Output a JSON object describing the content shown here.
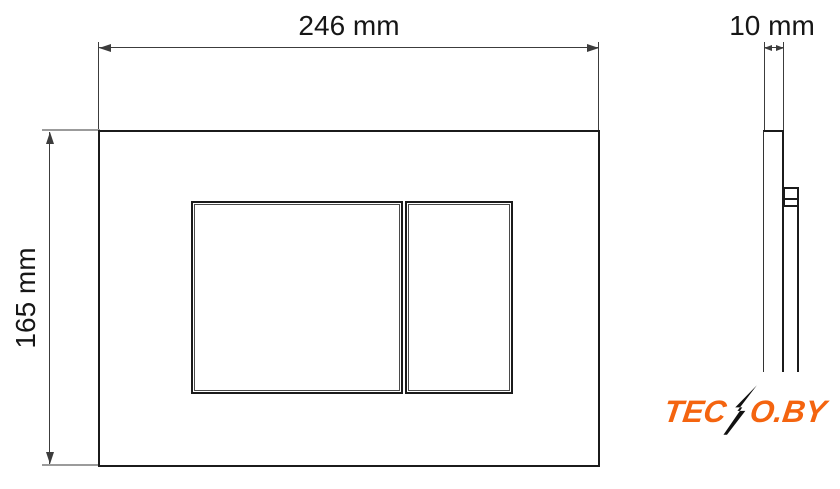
{
  "drawing": {
    "front_view": {
      "width_label": "246 mm",
      "height_label": "165 mm"
    },
    "side_view": {
      "depth_label": "10 mm"
    },
    "logo": {
      "prefix": "TEC",
      "suffix": "O.BY",
      "full_text": "TECNO.BY"
    },
    "colors": {
      "line": "#1b1b1b",
      "dim_line": "#3c3c3c",
      "extension": "#9b9b9b",
      "background": "#ffffff",
      "logo": "#f4640f",
      "bolt": "#111111"
    }
  }
}
